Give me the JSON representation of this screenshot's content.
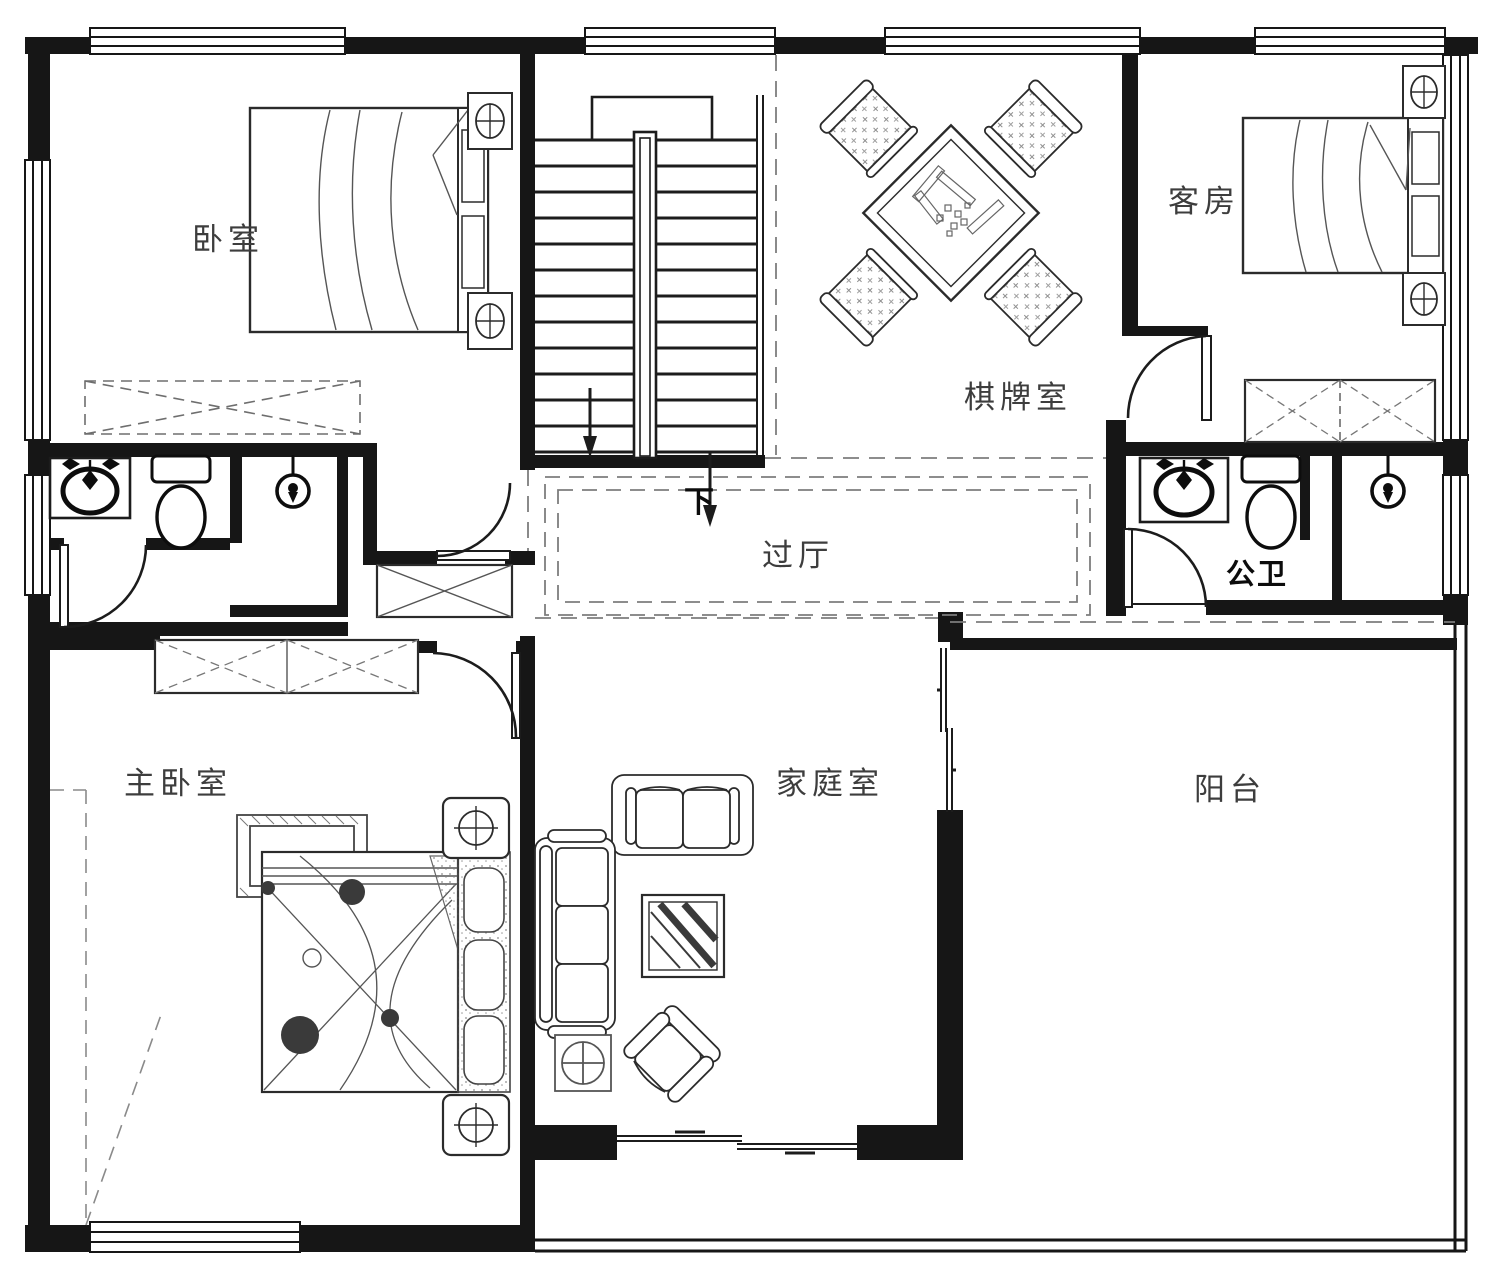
{
  "title": "floor-plan-second-storey",
  "rooms": {
    "bedroom": {
      "label": "卧室"
    },
    "guest_room": {
      "label": "客房"
    },
    "game_room": {
      "label": "棋牌室"
    },
    "hallway": {
      "label": "过厅"
    },
    "public_bath": {
      "label": "公卫"
    },
    "master_bedroom": {
      "label": "主卧室"
    },
    "family_room": {
      "label": "家庭室"
    },
    "balcony": {
      "label": "阳台"
    }
  },
  "stairs": {
    "down_label": "下"
  },
  "colors": {
    "wall": "#161616",
    "furniture_line": "#2b2b2b",
    "light_line": "#8a8a8a",
    "label_text": "#3d3d3d",
    "background": "#ffffff"
  }
}
